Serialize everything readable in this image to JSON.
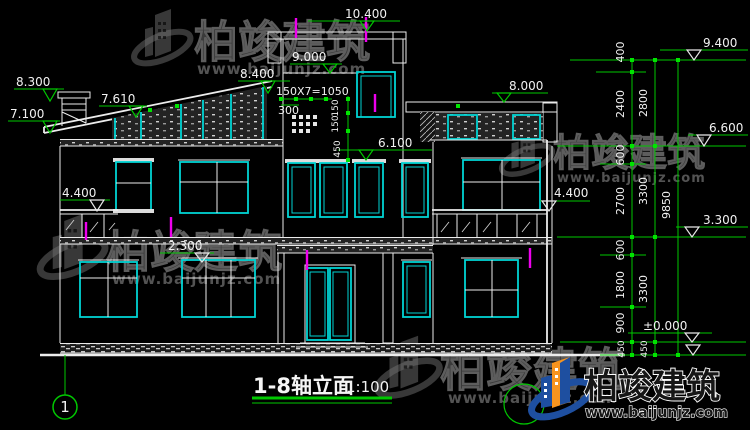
{
  "title": {
    "text": "1-8轴立面",
    "scale": "1:100"
  },
  "axis": {
    "bubble1": "1"
  },
  "levels": {
    "l8300": "8.300",
    "l7100": "7.100",
    "l7610": "7.610",
    "l8400": "8.400",
    "l10400": "10.400",
    "l9000": "9.000",
    "l6100": "6.100",
    "l8000": "8.000",
    "l4400l": "4.400",
    "l2300": "2.300",
    "l9400": "9.400",
    "l6600": "6.600",
    "l3300": "3.300",
    "l0000": "±0.000",
    "l4400r": "4.400"
  },
  "stair_dims": {
    "run": "150X7=1050",
    "offset": "300",
    "r1": "150",
    "r2": "150",
    "r3": "450"
  },
  "vdims": {
    "d400": "400",
    "d2400": "2400",
    "d2800": "2800",
    "d600a": "600",
    "d2700": "2700",
    "d3300a": "3300",
    "d9850": "9850",
    "d600b": "600",
    "d1800": "1800",
    "d3300b": "3300",
    "d900": "900",
    "d450a": "450",
    "d450b": "450"
  },
  "watermark": {
    "name": "柏竣建筑",
    "url": "www.baijunjz.com"
  },
  "logo": {
    "name": "柏竣建筑",
    "url": "www.baijunjz.com"
  },
  "colors": {
    "background": "#000000",
    "drawing_line": "#ececec",
    "window_frame": "#00d4d4",
    "dimension_green": "#00c800",
    "axis_magenta": "#ee00ee",
    "watermark_gray": "#8a8a8a",
    "logo_blue": "#1e4fa0",
    "logo_orange": "#f7941e"
  }
}
